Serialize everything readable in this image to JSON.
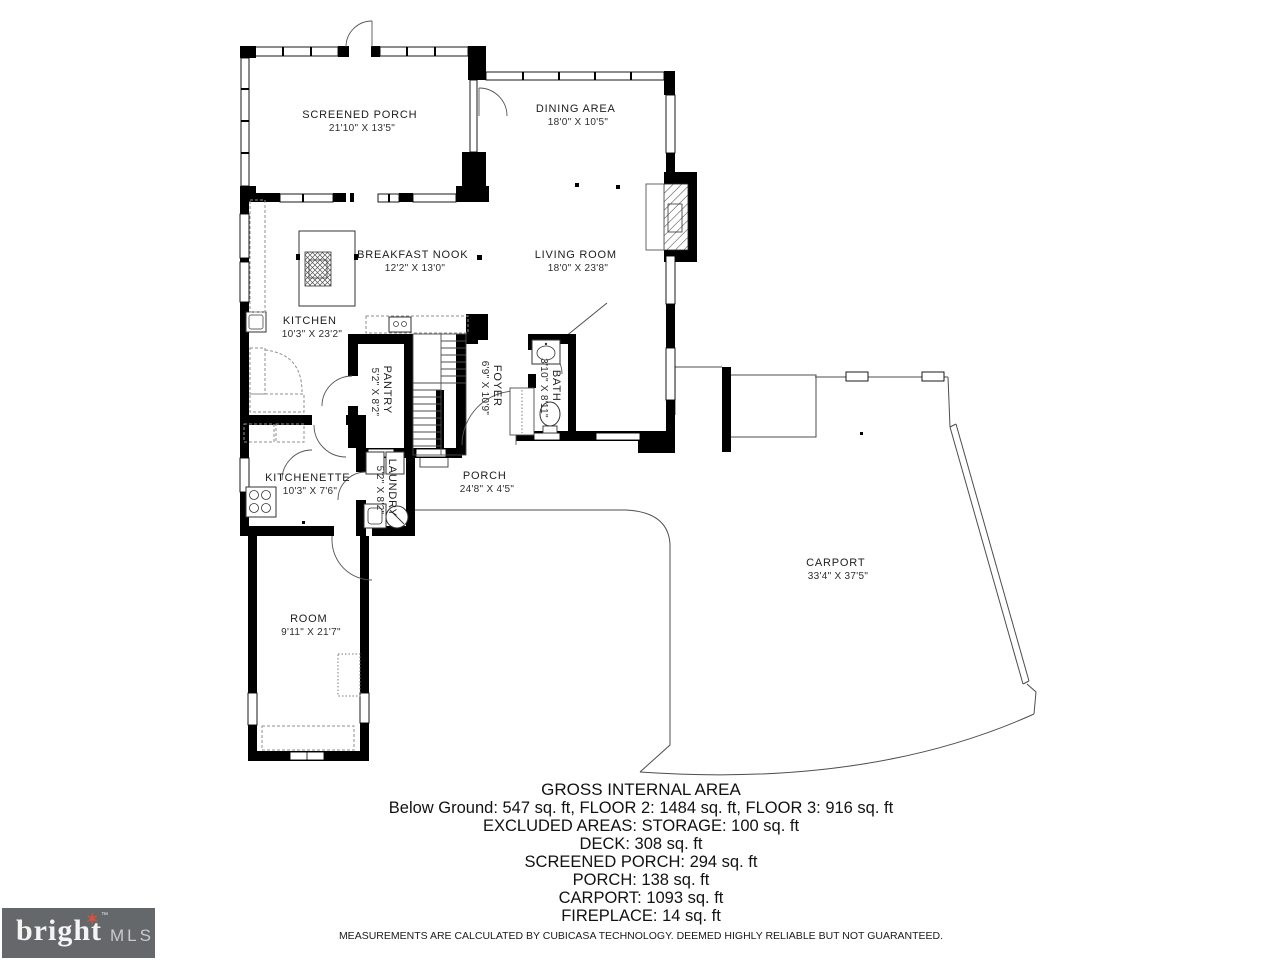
{
  "rooms": [
    {
      "name": "SCREENED PORCH",
      "dims": "21'10\" X 13'5\""
    },
    {
      "name": "DINING AREA",
      "dims": "18'0\" X 10'5\""
    },
    {
      "name": "BREAKFAST NOOK",
      "dims": "12'2\" X 13'0\""
    },
    {
      "name": "LIVING ROOM",
      "dims": "18'0\" X 23'8\""
    },
    {
      "name": "KITCHEN",
      "dims": "10'3\" X 23'2\""
    },
    {
      "name": "PANTRY",
      "dims": "5'2\" X 8'2\""
    },
    {
      "name": "FOYER",
      "dims": "6'9\" X 10'9\""
    },
    {
      "name": "BATH",
      "dims": "3'10\" X 8'11\""
    },
    {
      "name": "KITCHENETTE",
      "dims": "10'3\" X 7'6\""
    },
    {
      "name": "LAUNDRY",
      "dims": "5'2\" X 8'2\""
    },
    {
      "name": "PORCH",
      "dims": "24'8\" X 4'5\""
    },
    {
      "name": "CARPORT",
      "dims": "33'4\" X 37'5\""
    },
    {
      "name": "ROOM",
      "dims": "9'11\" X 21'7\""
    }
  ],
  "footer": {
    "title": "GROSS INTERNAL AREA",
    "lines": [
      "Below Ground: 547 sq. ft, FLOOR 2: 1484 sq. ft, FLOOR 3: 916 sq. ft",
      "EXCLUDED AREAS: STORAGE: 100 sq. ft",
      "DECK: 308 sq. ft",
      "SCREENED PORCH: 294 sq. ft",
      "PORCH: 138 sq. ft",
      "CARPORT: 1093 sq. ft",
      "FIREPLACE: 14 sq. ft"
    ],
    "disclaimer": "MEASUREMENTS ARE CALCULATED BY CUBICASA TECHNOLOGY. DEEMED HIGHLY RELIABLE BUT NOT GUARANTEED."
  },
  "logo": {
    "brand": "bright",
    "mls": "MLS",
    "tm": "™",
    "star": "✶"
  },
  "colors": {
    "wall": "#000000",
    "thin_line": "#4d4d4d",
    "logo_bg": "#65686b",
    "logo_star": "#d9513c"
  }
}
